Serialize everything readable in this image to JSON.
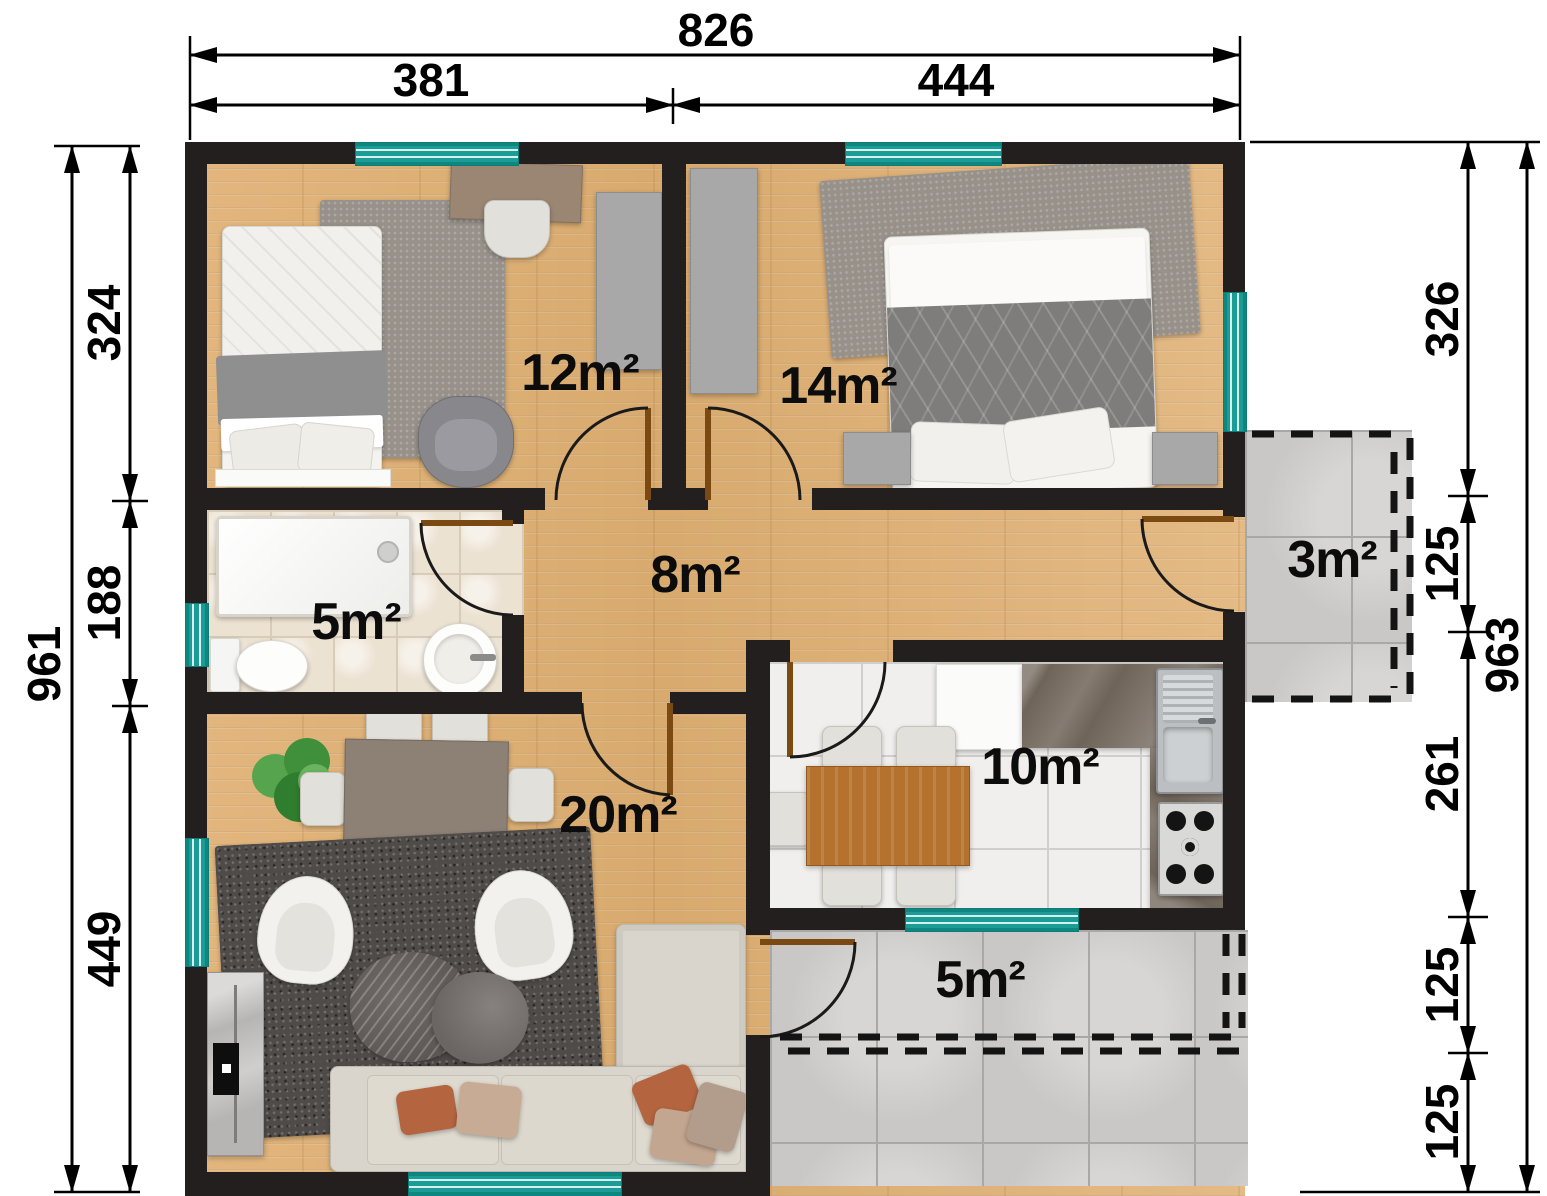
{
  "title": "apartment-floor-plan",
  "rooms": [
    {
      "id": "bedroom-small",
      "area": "12m²"
    },
    {
      "id": "bedroom-large",
      "area": "14m²"
    },
    {
      "id": "hallway",
      "area": "8m²"
    },
    {
      "id": "bathroom",
      "area": "5m²"
    },
    {
      "id": "living-dining",
      "area": "20m²"
    },
    {
      "id": "kitchen",
      "area": "10m²"
    },
    {
      "id": "terrace-side",
      "area": "3m²"
    },
    {
      "id": "terrace-back",
      "area": "5m²"
    }
  ],
  "dimensions": {
    "top": {
      "total": "826",
      "segments": [
        "381",
        "444"
      ]
    },
    "left": {
      "total": "961",
      "segments": [
        "324",
        "188",
        "449"
      ]
    },
    "right": {
      "total": "963",
      "segments": [
        "326",
        "125",
        "261",
        "125",
        "125"
      ]
    }
  },
  "colors": {
    "wall": "#221f1e",
    "window_accent": "#1a9d96",
    "wood_floor": "#ddb077",
    "bath_tile": "#ece2d2",
    "kitchen_tile": "#f0efed",
    "terrace_tile": "#c9c8c6",
    "dimension_text": "#000000"
  }
}
